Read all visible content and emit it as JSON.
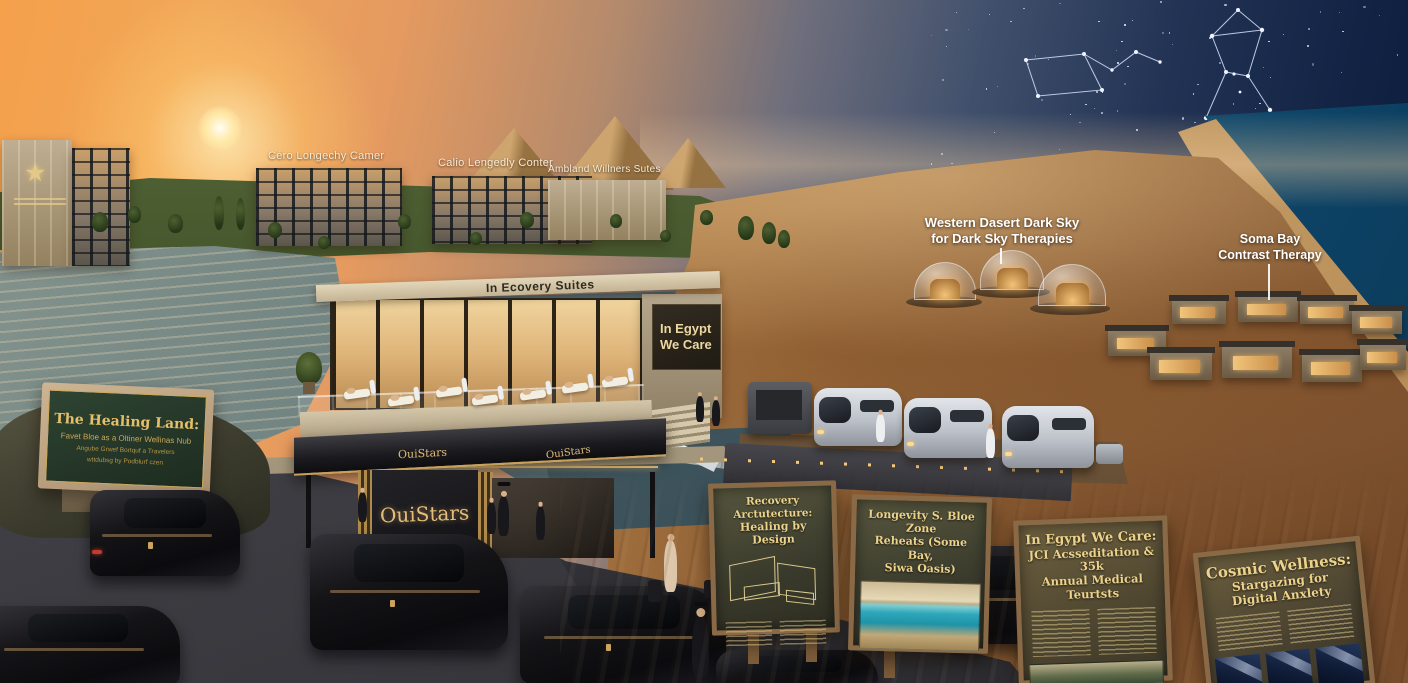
{
  "sky_labels": {
    "dark_sky_line1": "Western Dasert Dark Sky",
    "dark_sky_line2": "for Dark Sky Therapies",
    "soma_line1": "Soma Bay",
    "soma_line2": "Contrast Therapy"
  },
  "campus_labels": {
    "building1": "Céro Longechy Camer",
    "building2": "Calio Lengedly Conter",
    "building3": "Ambland Willners Sutes"
  },
  "hotel": {
    "star_icon": "★"
  },
  "recovery": {
    "roof_text": "In Ecovery Suites",
    "wall_sign_line1": "In Egypt",
    "wall_sign_line2": "We Care"
  },
  "entrance": {
    "brand": "OuiStars",
    "fascia_left": "OuiStars",
    "fascia_right": "OuiStars"
  },
  "healing_sign": {
    "title": "The Healing Land:",
    "subtitle": "Favet Bloe as a Oltiner Wellinas Nub",
    "line3": "Angube Grwef Bortquf a Travelers",
    "line4": "wttdubsg by Podblurf czen"
  },
  "boards": [
    {
      "title1": "Recovery Arctutecture:",
      "title2": "Healing by Design"
    },
    {
      "title1": "Longevity S. Bloe Zone",
      "title2": "Reheats (Some Bay,",
      "title3": "Siwa Oasis)"
    },
    {
      "title1": "In Egypt We Care:",
      "title2": "JCI Acsseditation & 35k",
      "title3": "Annual Medical Teurtsts"
    },
    {
      "title1": "Cosmic Wellness:",
      "title2": "Stargazing for Digital Anxlety"
    }
  ],
  "palette": {
    "gold_accent": "#d9b571",
    "sign_green": "#27392a",
    "night_sky": "#0c1a38",
    "sunset_orange": "#f5a04b",
    "desert_sand": "#b9854e",
    "sea_blue": "#176a8e"
  }
}
